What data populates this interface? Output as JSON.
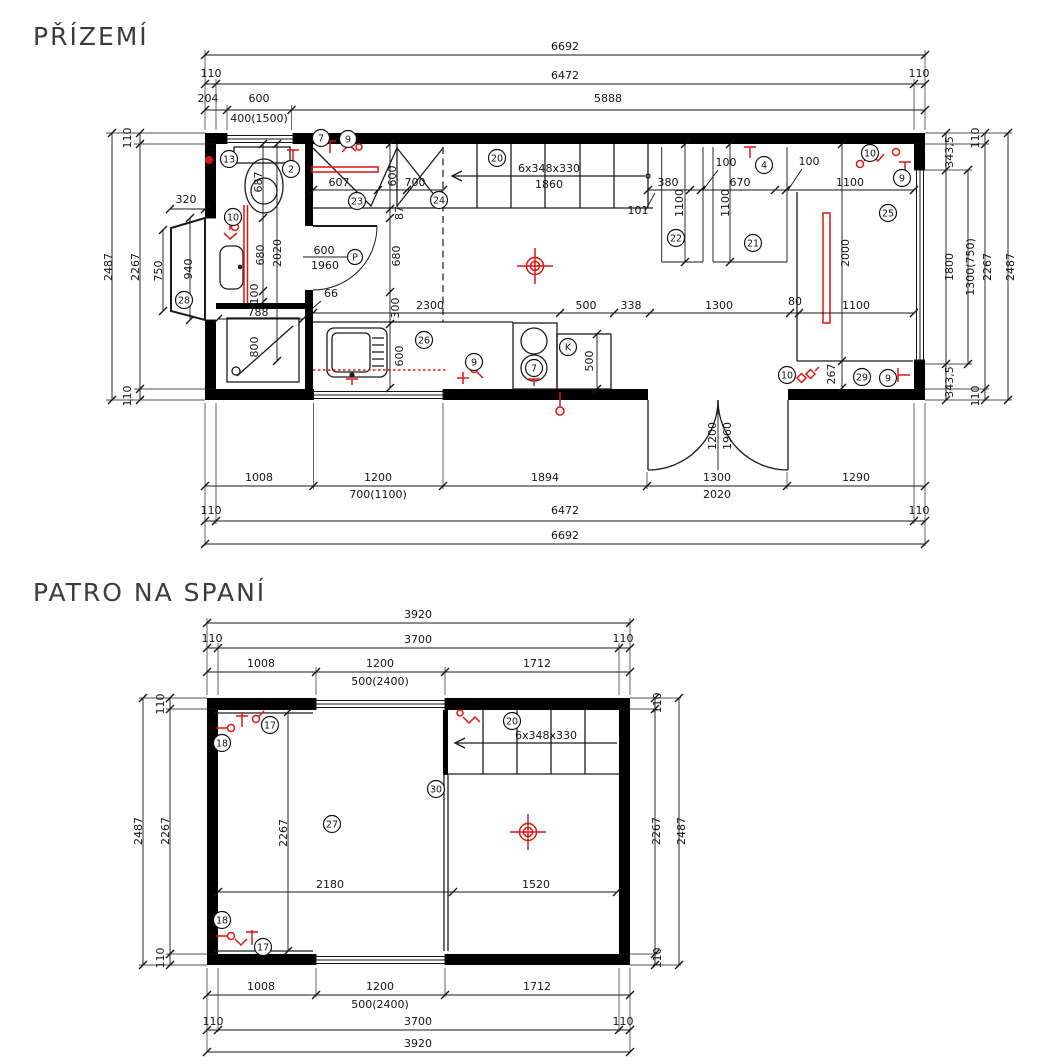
{
  "p1": {
    "title": "PŘÍZEMÍ",
    "t": {
      "total": "6692",
      "w1": "110",
      "inner": "6472",
      "w2": "110",
      "s204": "204",
      "s600": "600",
      "s5888": "5888",
      "winspec": "400(1500)"
    },
    "b": {
      "s1008": "1008",
      "s1200": "1200",
      "win": "700(1100)",
      "s1894": "1894",
      "s1300": "1300",
      "door": "2020",
      "s1290": "1290",
      "w1": "110",
      "inner": "6472",
      "w2": "110",
      "total": "6692"
    },
    "l": {
      "w1": "110",
      "total": "2487",
      "inner": "2267",
      "d750": "750",
      "d940": "940",
      "d320": "320",
      "w2": "110"
    },
    "r": {
      "w1": "110",
      "a343": "343,5",
      "d1800": "1800",
      "b343": "343,5",
      "winspec": "1300(750)",
      "inner": "2267",
      "total": "2487",
      "w2": "110"
    },
    "cv": {
      "a": "600",
      "b": "87",
      "c": "680",
      "d": "300",
      "e": "600"
    },
    "ch": {
      "a": "380",
      "g1": "100",
      "b": "670",
      "g2": "100",
      "c": "1100"
    },
    "cb": {
      "a": "2300",
      "b": "500",
      "c": "338",
      "d": "1300",
      "e": "80",
      "f": "1100"
    },
    "stair": {
      "spec": "6x348x330",
      "run": "1860",
      "n101": "101"
    },
    "bath": {
      "d687": "687",
      "d2020": "2020",
      "d680": "680",
      "d100": "100",
      "d788": "788",
      "d800": "800"
    },
    "hall": {
      "d607": "607",
      "d700": "700",
      "dw": "600",
      "dh": "1960",
      "d66": "66"
    },
    "kit": {
      "k500": "500"
    },
    "rr": {
      "w1": "1100",
      "w2": "1100",
      "d2000": "2000",
      "d267": "267"
    },
    "fd": {
      "w": "1200",
      "h": "1960"
    },
    "co": {
      "c13": "13",
      "c2": "2",
      "c7": "7",
      "c9": "9",
      "c23": "23",
      "c24": "24",
      "c20": "20",
      "c4": "4",
      "c10a": "10",
      "c9a": "9",
      "c22": "22",
      "c21": "21",
      "c25": "25",
      "c10b": "10",
      "c28": "28",
      "c26": "26",
      "c9b": "9",
      "c7b": "7",
      "cK": "K",
      "c10c": "10",
      "c29": "29",
      "c9c": "9",
      "cP": "P"
    }
  },
  "p2": {
    "title": "PATRO NA SPANÍ",
    "t": {
      "total": "3920",
      "w1": "110",
      "inner": "3700",
      "w2": "110",
      "s1008": "1008",
      "s1200": "1200",
      "s1712": "1712",
      "winspec": "500(2400)"
    },
    "b": {
      "s1008": "1008",
      "s1200": "1200",
      "s1712": "1712",
      "winspec": "500(2400)",
      "w1": "110",
      "inner": "3700",
      "w2": "110",
      "total": "3920"
    },
    "l": {
      "w1": "110",
      "total": "2487",
      "inner": "2267",
      "w2": "110"
    },
    "r": {
      "w1": "110",
      "inner": "2267",
      "total": "2487",
      "w2": "110"
    },
    "in": {
      "d2267": "2267",
      "d2180": "2180",
      "d1520": "1520",
      "spec": "6x348x330"
    },
    "co": {
      "c17a": "17",
      "c18a": "18",
      "c20": "20",
      "c30": "30",
      "c27": "27",
      "c18b": "18",
      "c17b": "17"
    }
  }
}
